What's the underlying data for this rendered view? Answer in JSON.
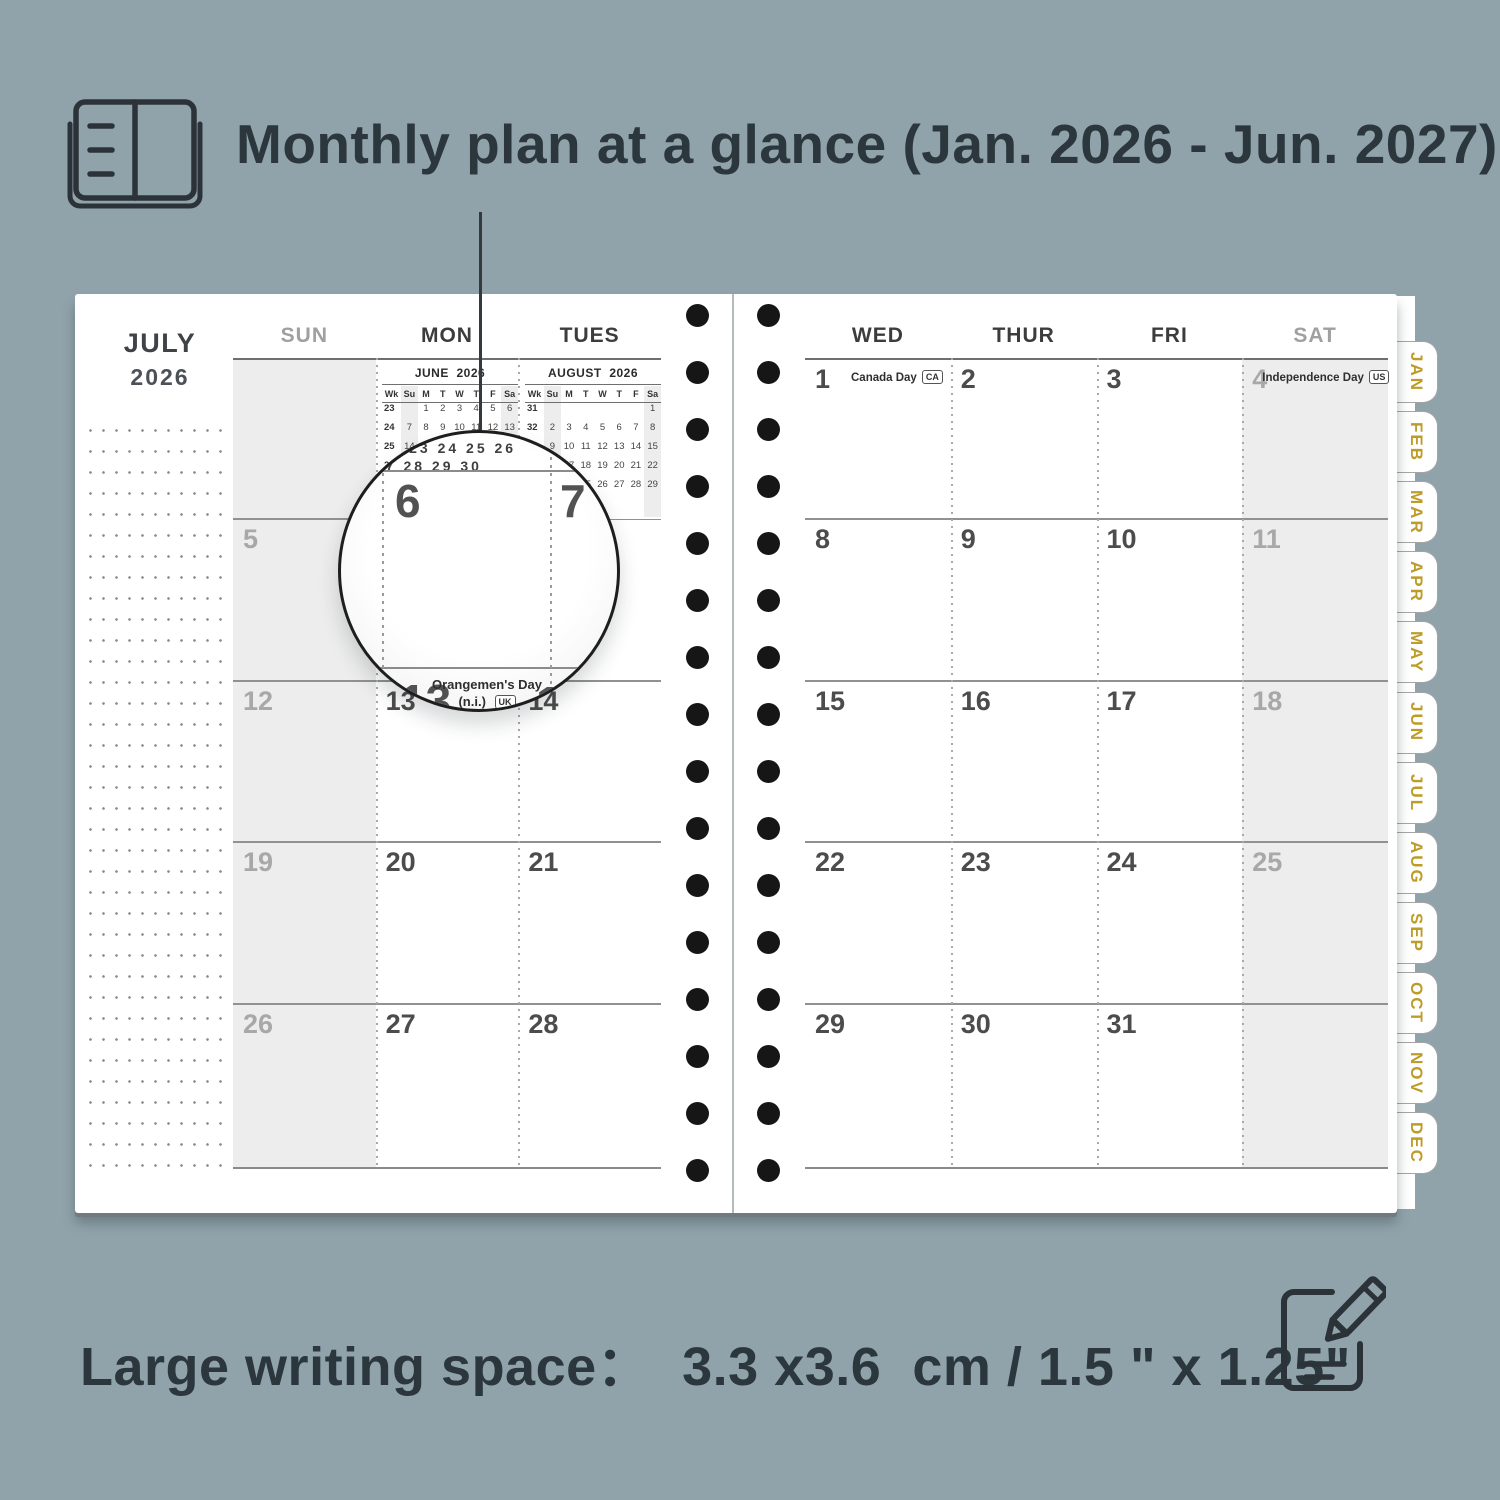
{
  "colors": {
    "background": "#90a3ab",
    "text_dark": "#2b363d",
    "tab_gold": "#bd9d28",
    "weekend_shade": "#ededed"
  },
  "header": {
    "title": "Monthly plan at a glance (Jan. 2026 - Jun. 2027)"
  },
  "footer": {
    "caption": "Large writing space：  3.3 x3.6  cm / 1.5 \" x 1.25\""
  },
  "spread": {
    "left_page": {
      "month_label": "JULY",
      "year_label": "2026",
      "day_headers": [
        {
          "text": "SUN",
          "muted": true
        },
        {
          "text": "MON",
          "muted": false
        },
        {
          "text": "TUES",
          "muted": false
        }
      ],
      "weeks": [
        [
          {
            "kind": "blank"
          },
          {
            "kind": "minical"
          },
          {
            "kind": "minical"
          }
        ],
        [
          {
            "d": "5"
          },
          {
            "d": "6"
          },
          {
            "d": "7"
          }
        ],
        [
          {
            "d": "12"
          },
          {
            "d": "13"
          },
          {
            "d": "14"
          }
        ],
        [
          {
            "d": "19"
          },
          {
            "d": "20"
          },
          {
            "d": "21"
          }
        ],
        [
          {
            "d": "26"
          },
          {
            "d": "27"
          },
          {
            "d": "28"
          }
        ]
      ]
    },
    "right_page": {
      "day_headers": [
        {
          "text": "WED",
          "muted": false
        },
        {
          "text": "THUR",
          "muted": false
        },
        {
          "text": "FRI",
          "muted": false
        },
        {
          "text": "SAT",
          "muted": true
        }
      ],
      "weeks": [
        [
          {
            "d": "1",
            "holiday": "Canada Day",
            "badge": "CA"
          },
          {
            "d": "2"
          },
          {
            "d": "3"
          },
          {
            "d": "4",
            "holiday": "Independence Day",
            "badge": "US"
          }
        ],
        [
          {
            "d": "8"
          },
          {
            "d": "9"
          },
          {
            "d": "10"
          },
          {
            "d": "11"
          }
        ],
        [
          {
            "d": "15"
          },
          {
            "d": "16"
          },
          {
            "d": "17"
          },
          {
            "d": "18"
          }
        ],
        [
          {
            "d": "22"
          },
          {
            "d": "23"
          },
          {
            "d": "24"
          },
          {
            "d": "25"
          }
        ],
        [
          {
            "d": "29"
          },
          {
            "d": "30"
          },
          {
            "d": "31"
          },
          {
            "kind": "blank"
          }
        ]
      ]
    },
    "mini_calendars": [
      {
        "title": "JUNE  2026",
        "col_headers": [
          "Wk",
          "Su",
          "M",
          "T",
          "W",
          "T",
          "F",
          "Sa"
        ],
        "rows": [
          [
            "23",
            "",
            "1",
            "2",
            "3",
            "4",
            "5",
            "6"
          ],
          [
            "24",
            "7",
            "8",
            "9",
            "10",
            "11",
            "12",
            "13"
          ],
          [
            "25",
            "14",
            "15",
            "16",
            "17",
            "18",
            "19",
            "20"
          ],
          [
            "26",
            "21",
            "22",
            "23",
            "24",
            "25",
            "26",
            "27"
          ],
          [
            "27",
            "28",
            "29",
            "30",
            "",
            "",
            "",
            ""
          ]
        ]
      },
      {
        "title": "AUGUST  2026",
        "col_headers": [
          "Wk",
          "Su",
          "M",
          "T",
          "W",
          "T",
          "F",
          "Sa"
        ],
        "rows": [
          [
            "31",
            "",
            "",
            "",
            "",
            "",
            "",
            "1"
          ],
          [
            "32",
            "2",
            "3",
            "4",
            "5",
            "6",
            "7",
            "8"
          ],
          [
            "33",
            "9",
            "10",
            "11",
            "12",
            "13",
            "14",
            "15"
          ],
          [
            "34",
            "16",
            "17",
            "18",
            "19",
            "20",
            "21",
            "22"
          ],
          [
            "35",
            "23",
            "24",
            "25",
            "26",
            "27",
            "28",
            "29"
          ],
          [
            "36",
            "30",
            "31",
            "",
            "",
            "",
            "",
            ""
          ]
        ]
      }
    ],
    "tabs": [
      "JAN",
      "FEB",
      "MAR",
      "APR",
      "MAY",
      "JUN",
      "JUL",
      "AUG",
      "SEP",
      "OCT",
      "NOV",
      "DEC"
    ]
  },
  "magnifier": {
    "fragments": [
      "1  2  23 24 25 26",
      "27 28 29 30"
    ],
    "day_a": "6",
    "day_b": "7",
    "day_c": "13",
    "day_d": "14",
    "holiday_line1": "Orangemen's Day",
    "holiday_line2": "(n.i.)",
    "holiday_badge": "UK"
  }
}
